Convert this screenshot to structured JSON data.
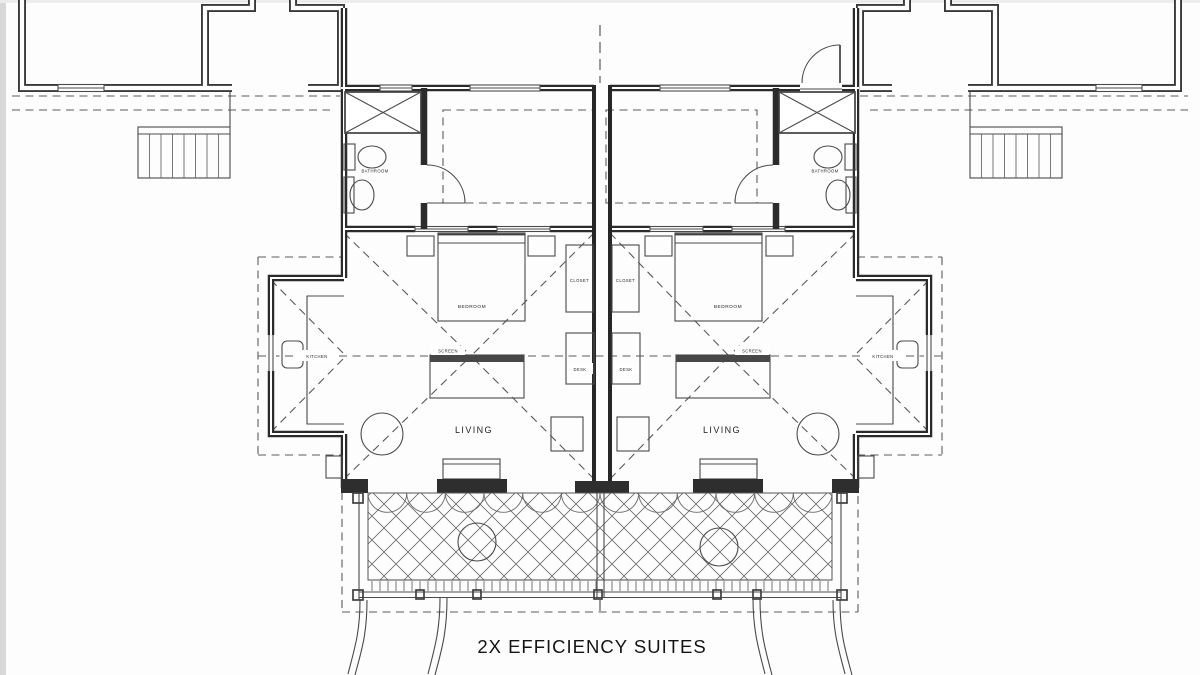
{
  "title": "2X EFFICIENCY SUITES",
  "units": {
    "left": {
      "bathroom": "BATHROOM",
      "bedroom": "BEDROOM",
      "closet": "CLOSET",
      "desk": "DESK",
      "screen": "SCREEN",
      "kitchen": "KITCHEN",
      "living": "LIVING"
    },
    "right": {
      "bathroom": "BATHROOM",
      "bedroom": "BEDROOM",
      "closet": "CLOSET",
      "desk": "DESK",
      "screen": "SCREEN",
      "kitchen": "KITCHEN",
      "living": "LIVING"
    }
  },
  "colors": {
    "wall_line": "#2b2b2b",
    "thin_line": "#4a4a4a",
    "dashed_line": "#5a5a5a",
    "text": "#1f1f1f",
    "background": "#fdfdfd",
    "page_edge": "#d8d8d8"
  }
}
